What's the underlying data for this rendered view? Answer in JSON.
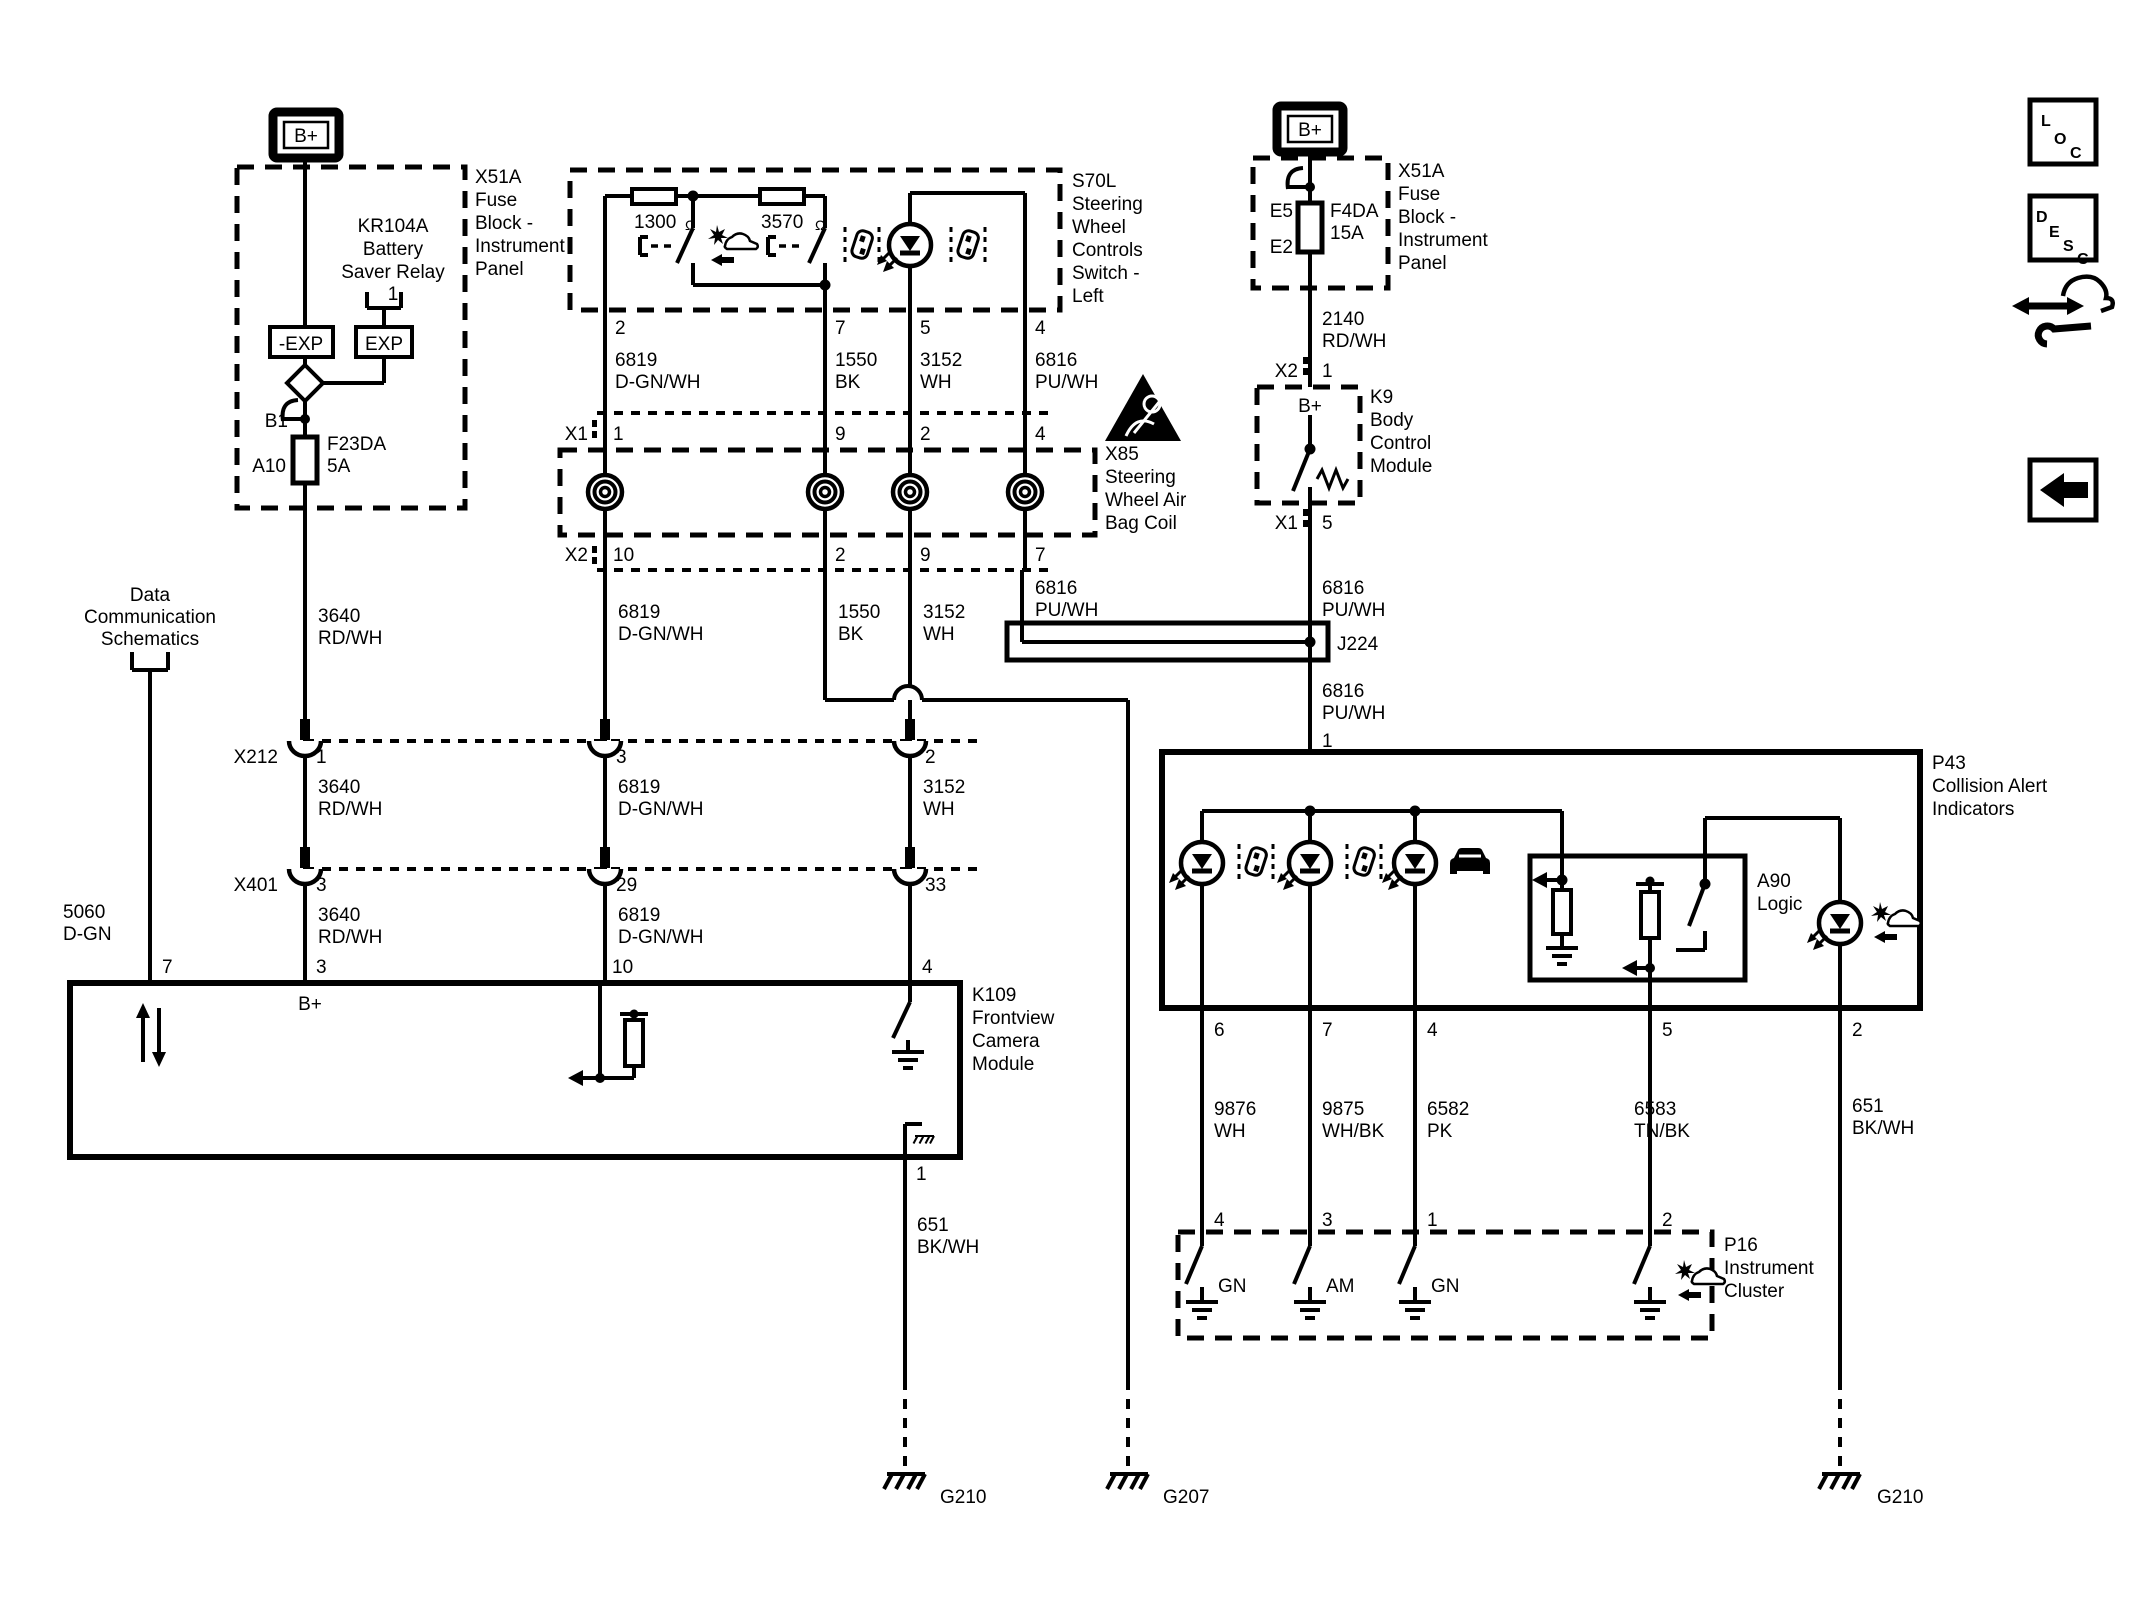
{
  "colors": {
    "ink": "#000000",
    "paper": "#ffffff"
  },
  "fuse_block_label": [
    "X51A",
    "Fuse",
    "Block -",
    "Instrument",
    "Panel"
  ],
  "battery": {
    "b_plus": "B+"
  },
  "relay": {
    "title": [
      "KR104A",
      "Battery",
      "Saver Relay",
      "1"
    ],
    "neg_exp": "-EXP",
    "exp": "EXP"
  },
  "fuse_left": {
    "pin_top": "B1",
    "pin_bottom": "A10",
    "name": "F23DA",
    "rating": "5A"
  },
  "fuse_right": {
    "pin_top": "E5",
    "pin_bottom": "E2",
    "name": "F4DA",
    "rating": "15A"
  },
  "data_comm": {
    "lines": [
      "Data",
      "Communication",
      "Schematics"
    ]
  },
  "s70l": {
    "title": [
      "S70L",
      "Steering",
      "Wheel",
      "Controls",
      "Switch -",
      "Left"
    ],
    "r1": "1300",
    "r2": "3570",
    "ohm": "Ω",
    "pins": {
      "p2": "2",
      "p7": "7",
      "p5": "5",
      "p4": "4"
    }
  },
  "x85": {
    "title": [
      "X85",
      "Steering",
      "Wheel Air",
      "Bag Coil"
    ],
    "x1": "X1",
    "x2": "X2",
    "x1_pins": [
      "1",
      "9",
      "2",
      "4"
    ],
    "x2_pins": [
      "10",
      "2",
      "9",
      "7"
    ]
  },
  "x212": {
    "name": "X212",
    "pins": [
      "1",
      "3",
      "2"
    ]
  },
  "x401": {
    "name": "X401",
    "pins": [
      "3",
      "29",
      "33"
    ]
  },
  "k109": {
    "title": [
      "K109",
      "Frontview",
      "Camera",
      "Module"
    ],
    "b_plus": "B+",
    "pins": {
      "p7": "7",
      "p3": "3",
      "p10": "10",
      "p4": "4",
      "p1": "1"
    }
  },
  "k9": {
    "title": [
      "K9",
      "Body",
      "Control",
      "Module"
    ],
    "b_plus": "B+",
    "x2": "X2",
    "x2_pin": "1",
    "x1": "X1",
    "x1_pin": "5"
  },
  "j224": {
    "name": "J224"
  },
  "p43": {
    "title": [
      "P43",
      "Collision Alert",
      "Indicators"
    ],
    "pin_in": "1",
    "pins": [
      "6",
      "7",
      "4",
      "5",
      "2"
    ],
    "a90": {
      "title": [
        "A90",
        "Logic"
      ]
    }
  },
  "p16": {
    "title": [
      "P16",
      "Instrument",
      "Cluster"
    ],
    "pins": [
      "4",
      "3",
      "1",
      "2"
    ],
    "labels": [
      "GN",
      "AM",
      "GN"
    ]
  },
  "wires": {
    "w3640": {
      "num": "3640",
      "color": "RD/WH"
    },
    "w6819": {
      "num": "6819",
      "color": "D-GN/WH"
    },
    "w1550": {
      "num": "1550",
      "color": "BK"
    },
    "w3152": {
      "num": "3152",
      "color": "WH"
    },
    "w6816": {
      "num": "6816",
      "color": "PU/WH"
    },
    "w2140": {
      "num": "2140",
      "color": "RD/WH"
    },
    "w5060": {
      "num": "5060",
      "color": "D-GN"
    },
    "w651": {
      "num": "651",
      "color": "BK/WH"
    },
    "w9876": {
      "num": "9876",
      "color": "WH"
    },
    "w9875": {
      "num": "9875",
      "color": "WH/BK"
    },
    "w6582": {
      "num": "6582",
      "color": "PK"
    },
    "w6583": {
      "num": "6583",
      "color": "TN/BK"
    }
  },
  "grounds": {
    "g210_left": "G210",
    "g207": "G207",
    "g210_right": "G210"
  },
  "corner": {
    "loc": [
      "L",
      "O",
      "C"
    ],
    "desc": [
      "D",
      "E",
      "S",
      "C"
    ]
  }
}
